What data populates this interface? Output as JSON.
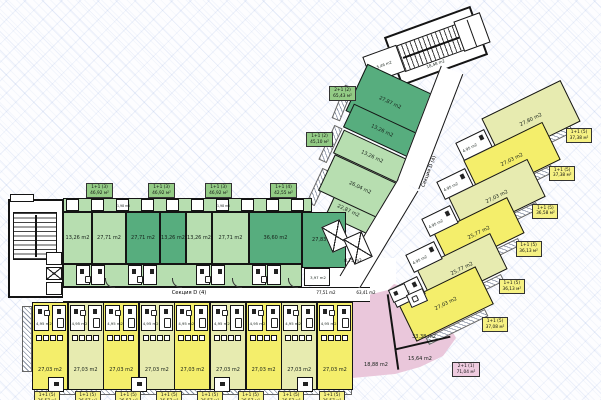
{
  "colors": {
    "wall": "#141414",
    "dark-green": "#57ad7e",
    "light-green": "#b7deb0",
    "bright-yellow": "#f4ee6b",
    "pale-yellow": "#e7ebb0",
    "pink": "#eac7db",
    "tag-green": "#93cb85",
    "tag-yellow": "#f6f183",
    "tag-pink": "#eecbdf"
  },
  "left": {
    "corridor_label": "Секция D (4)",
    "stair_area": "18,48 m2",
    "stair_top_room": "4,45 m2",
    "closet_a": "1,98 m2",
    "closet_b": "1,98 m2",
    "green_rooms": [
      "13,26 m2",
      "27,71 m2",
      "27,71 m2",
      "13,26 m2",
      "13,26 m2",
      "27,71 m2",
      "36,60 m2"
    ],
    "corner_room": "27,83 m2",
    "corner_bath": "3,97 m2",
    "top_tags": [
      {
        "type": "1+1 (3)",
        "area": "46,92 м²"
      },
      {
        "type": "1+1 (3)",
        "area": "46,92 м²"
      },
      {
        "type": "1+1 (3)",
        "area": "46,92 м²"
      },
      {
        "type": "1+1 (4)",
        "area": "42,55 м²"
      }
    ],
    "yellow_units": [
      "bright",
      "pale",
      "bright",
      "pale",
      "bright",
      "pale",
      "bright",
      "pale",
      "bright"
    ],
    "yellow_room_area": "27,03 m2",
    "yellow_bath_area": "4,95 m2",
    "bottom_tags": [
      {
        "type": "1+1 (5)",
        "area": "36,57 м²"
      },
      {
        "type": "1+1 (5)",
        "area": "36,57 м²"
      },
      {
        "type": "1+1 (5)",
        "area": "36,57 м²"
      },
      {
        "type": "1+1 (5)",
        "area": "36,57 м²"
      },
      {
        "type": "1+1 (5)",
        "area": "36,57 м²"
      },
      {
        "type": "1+1 (5)",
        "area": "36,57 м²"
      },
      {
        "type": "1+1 (5)",
        "area": "36,57 м²"
      },
      {
        "type": "1+1 (5)",
        "area": "36,57 м²"
      }
    ]
  },
  "junction": {
    "lobby_area": "8,75 m2",
    "corridor_area_a": "77,51 m2",
    "corridor_area_b": "63,41 m2"
  },
  "wing": {
    "corridor_label": "Секция D (4)",
    "stair_area": "18,48 m2",
    "small_room": "5,46 m2",
    "green_rooms": [
      "27,87 m2",
      "13,26 m2",
      "13,26 m2",
      "26,04 m2",
      "22,87 m2"
    ],
    "yellow_rooms": [
      "27,80 m2",
      "27,03 m2",
      "27,03 m2",
      "25,77 m2",
      "25,77 m2",
      "27,03 m2"
    ],
    "bath_area": "4,95 m2",
    "west_tags": [
      {
        "type": "2+1 (2)",
        "area": "65,43 м²"
      },
      {
        "type": "1+1 (2)",
        "area": "45,10 м²"
      }
    ],
    "side_tags": [
      {
        "type": "1+1 (5)",
        "area": "37,38 м²"
      },
      {
        "type": "1+1 (5)",
        "area": "37,38 м²"
      },
      {
        "type": "1+1 (5)",
        "area": "36,58 м²"
      },
      {
        "type": "1+1 (5)",
        "area": "36,13 м²"
      },
      {
        "type": "1+1 (5)",
        "area": "36,13 м²"
      },
      {
        "type": "1+1 (5)",
        "area": "37,08 м²"
      }
    ]
  },
  "pink": {
    "rooms": [
      "33,38 m2",
      "18,88 m2",
      "15,64 m2"
    ],
    "tag": {
      "type": "2+1 (1)",
      "area": "71,04 м²"
    }
  }
}
